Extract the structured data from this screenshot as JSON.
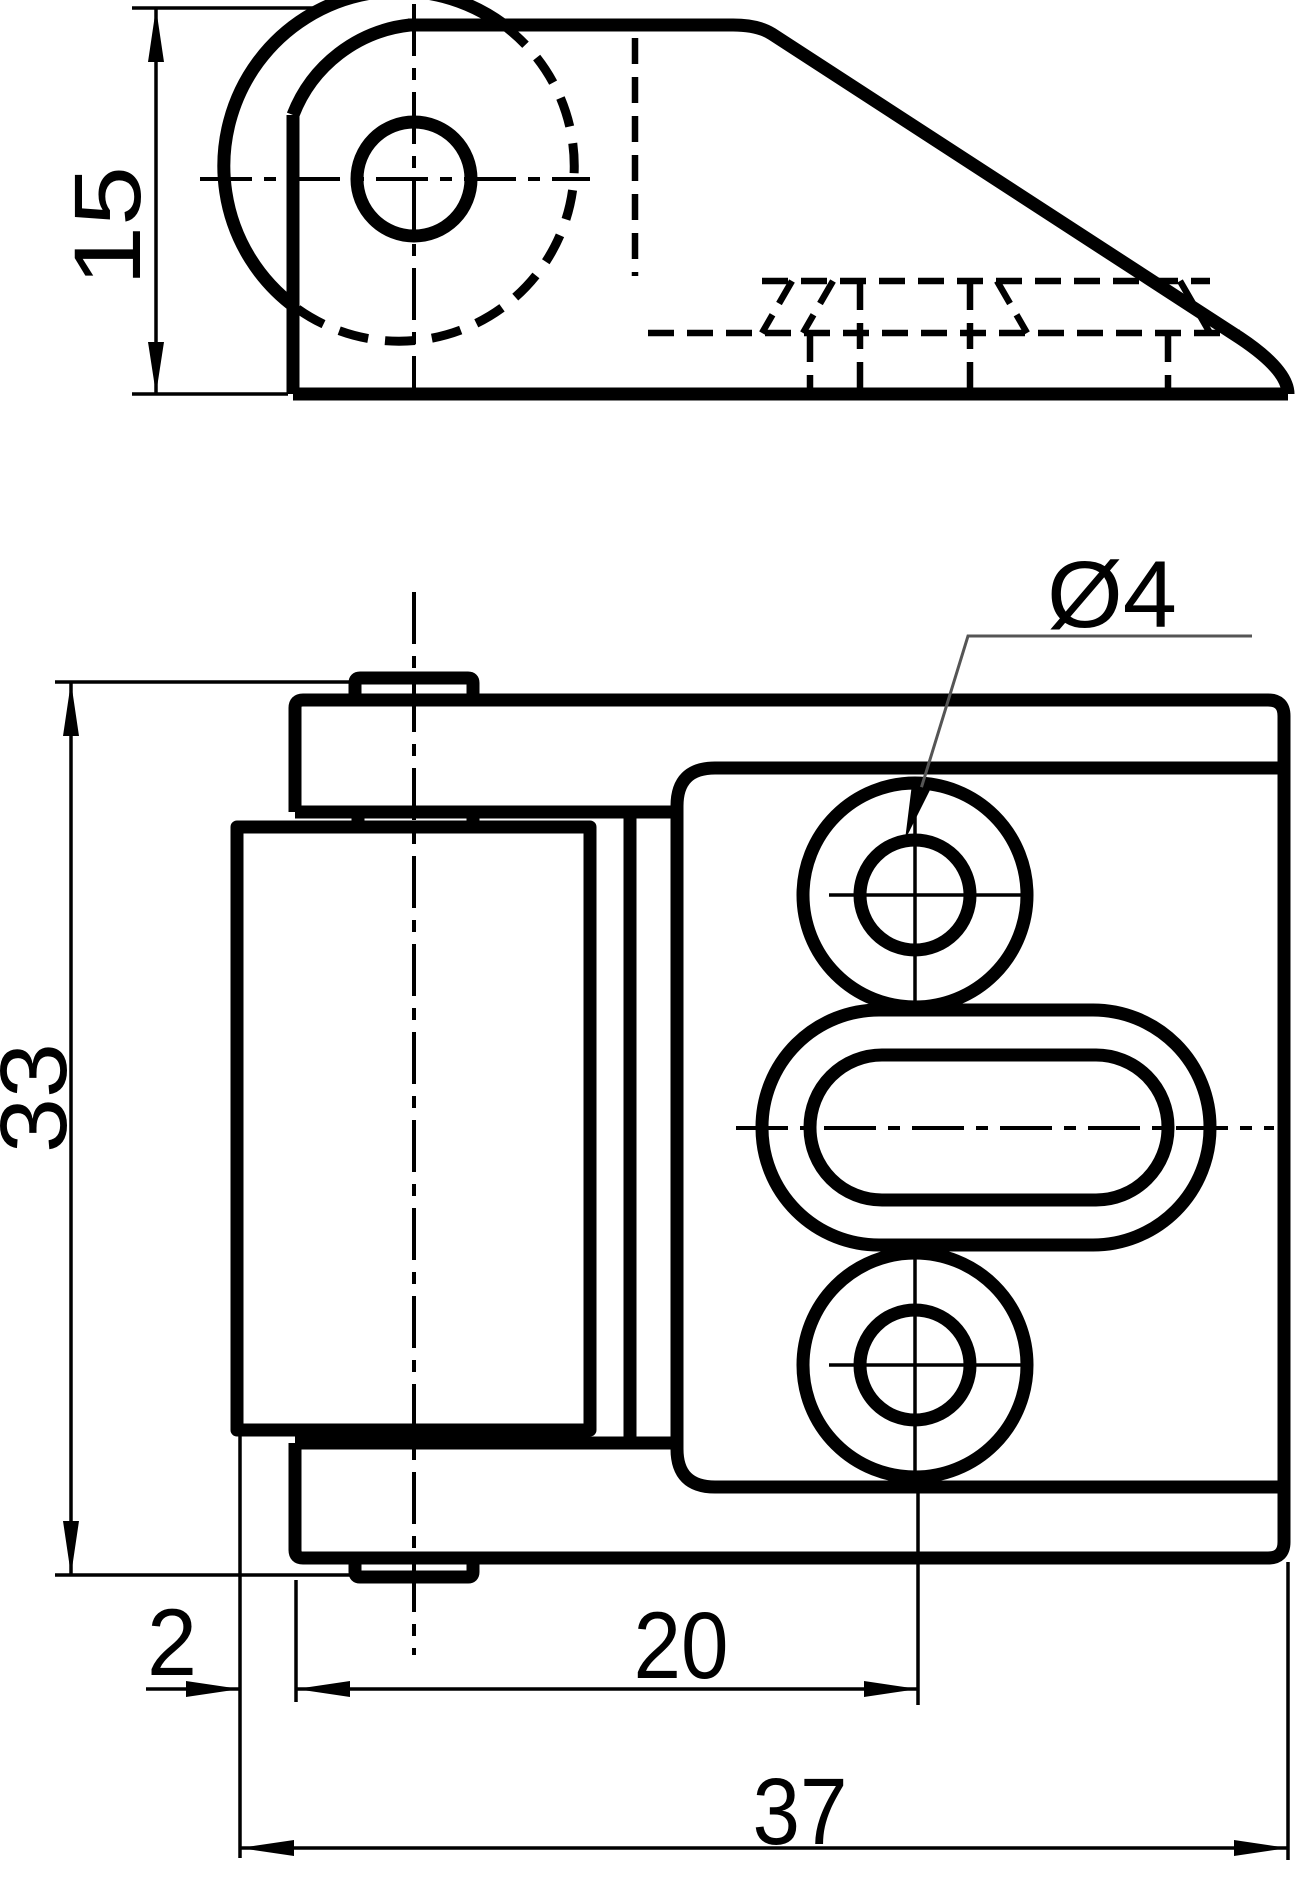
{
  "drawing": {
    "dimensions": {
      "side_view_height": "15",
      "overall_height": "33",
      "leaf_offset": "2",
      "hole_center_distance": "20",
      "overall_width": "37",
      "hole_diameter": "Ø4"
    },
    "colors": {
      "line": "#000000",
      "background": "#ffffff",
      "leader_line": "#555555"
    }
  }
}
